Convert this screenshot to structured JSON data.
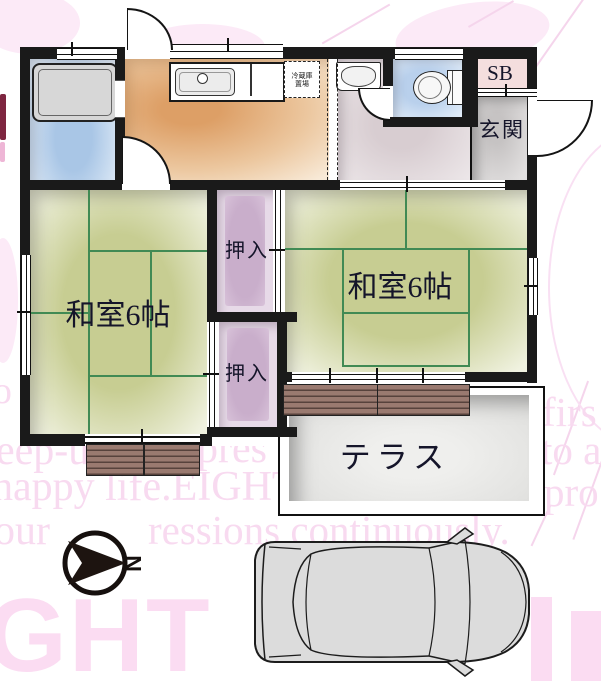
{
  "labels": {
    "room_left": "和室6帖",
    "room_right": "和室6帖",
    "closet_upper": "押入",
    "closet_lower": "押入",
    "entrance": "玄関",
    "shoebox": "SB",
    "terrace": "テラス",
    "fridge_line1": "冷蔵庫",
    "fridge_line2": "置場",
    "compass_north": "N"
  },
  "watermark": {
    "line1_left": "eep-u",
    "line1_right": "pres",
    "line2": "happy life.EIGHT",
    "line3_left": "our",
    "line3_right": "ressions continuously.",
    "right_frag1": "firs",
    "right_frag2": "to a",
    "right_frag3": "pro",
    "left_frag": "co",
    "big_letters": "GHT"
  },
  "colors": {
    "wall": "#1a1a1a",
    "tatami_green": "#c7cd92",
    "tatami_line": "#418a54",
    "kitchen_orange": "#dd9f66",
    "bath_blue": "#a9c6e6",
    "toilet_blue": "#b9d0ec",
    "closet_purple": "#c9aecb",
    "deck_brown": "#9a7a70",
    "terrace_gray": "#e4e4e2",
    "genkan_gray": "#cac7c7",
    "watermark_pink": "#f8daf0"
  }
}
